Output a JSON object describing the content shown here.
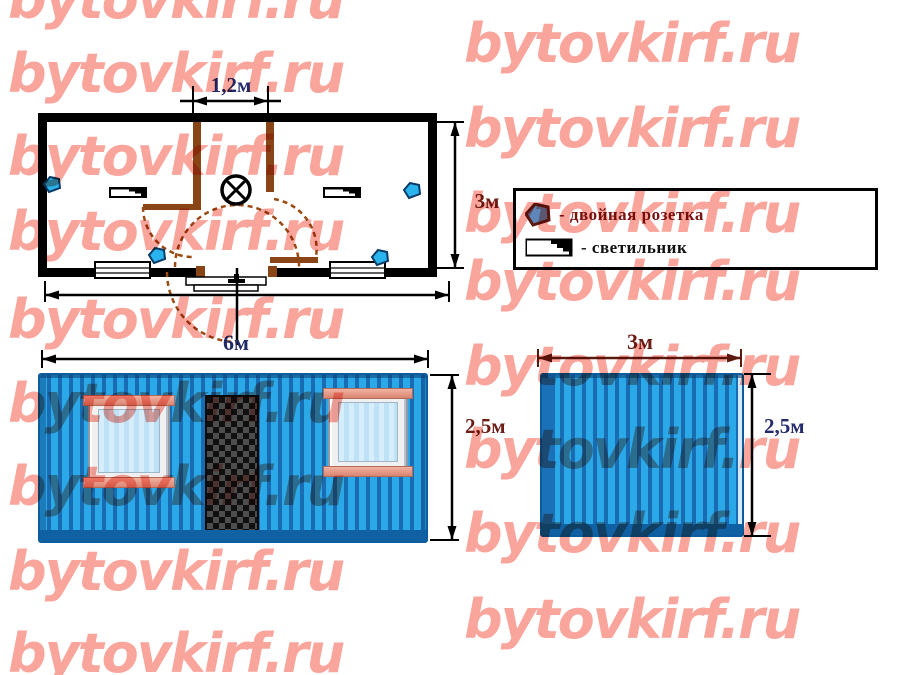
{
  "watermark": {
    "text": "bytovkirf.ru",
    "color": "#f9a59c",
    "positions": [
      {
        "x": 8,
        "y": -32
      },
      {
        "x": 8,
        "y": 42
      },
      {
        "x": 8,
        "y": 125
      },
      {
        "x": 8,
        "y": 200
      },
      {
        "x": 8,
        "y": 288
      },
      {
        "x": 8,
        "y": 372
      },
      {
        "x": 8,
        "y": 455
      },
      {
        "x": 8,
        "y": 540
      },
      {
        "x": 8,
        "y": 622
      },
      {
        "x": 464,
        "y": 12
      },
      {
        "x": 464,
        "y": 97
      },
      {
        "x": 464,
        "y": 182
      },
      {
        "x": 464,
        "y": 250
      },
      {
        "x": 464,
        "y": 335
      },
      {
        "x": 464,
        "y": 418
      },
      {
        "x": 464,
        "y": 502
      },
      {
        "x": 464,
        "y": 588
      }
    ]
  },
  "plan": {
    "dim_door_width": "1,2м",
    "dim_depth": "3м"
  },
  "legend": {
    "items": [
      {
        "icon": "double-socket-icon",
        "label": "- двойная розетка",
        "color": "#7a1212"
      },
      {
        "icon": "light-fixture-icon",
        "label": "- светильник",
        "color": "#111111"
      }
    ]
  },
  "front_elevation": {
    "dim_width": "6м",
    "dim_height": "2,5м"
  },
  "side_elevation": {
    "dim_width": "3м",
    "dim_height": "2,5м"
  },
  "colors": {
    "body_blue": "#1f8fd2",
    "stripe_light": "#2ba8e8",
    "stripe_dark": "#1a6cb2",
    "trim_blue": "#1061a4",
    "partition_brown": "#8a4516",
    "socket_blue": "#2ab4ee",
    "dim_navy": "#252a6e",
    "dim_maroon": "#6e1d15",
    "watermark_pink": "#f9a59c"
  }
}
